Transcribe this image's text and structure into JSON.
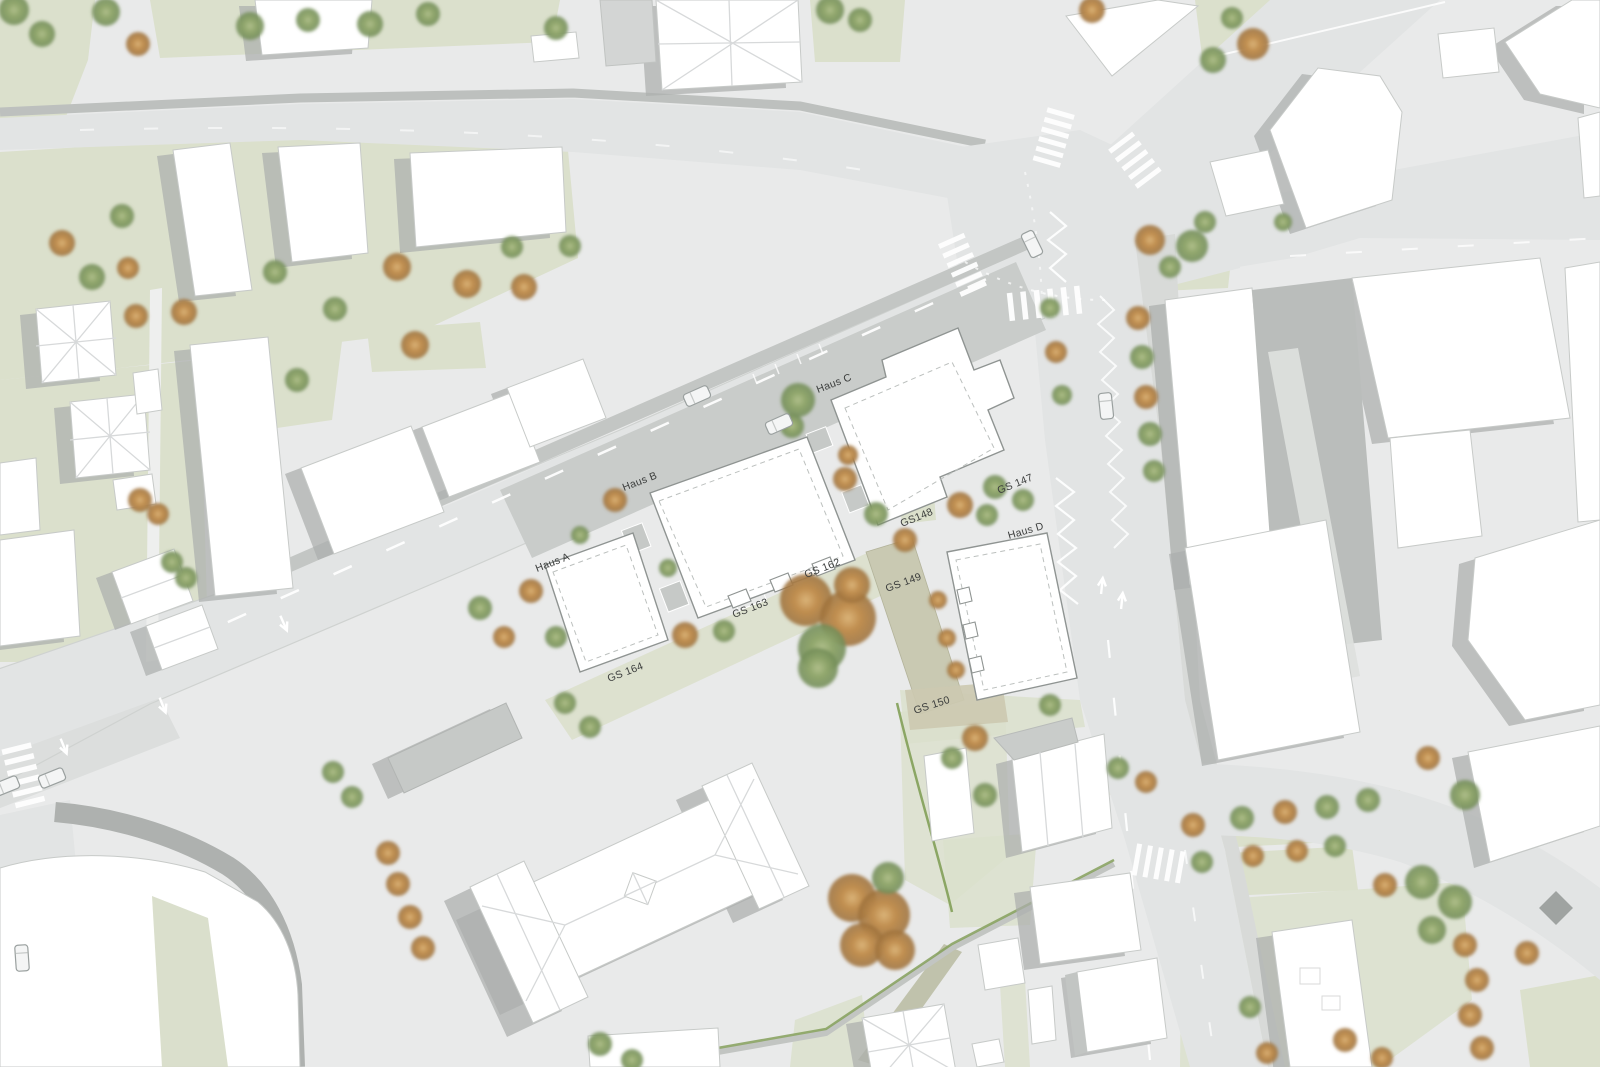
{
  "plan": {
    "title": "Urban site plan with new buildings Haus A-D and parcels",
    "labels": [
      {
        "id": "haus-a",
        "text": "Haus A",
        "x": 537,
        "y": 572,
        "rotate": -21
      },
      {
        "id": "haus-b",
        "text": "Haus B",
        "x": 624,
        "y": 491,
        "rotate": -21
      },
      {
        "id": "haus-c",
        "text": "Haus C",
        "x": 818,
        "y": 393,
        "rotate": -21
      },
      {
        "id": "haus-d",
        "text": "Haus D",
        "x": 1009,
        "y": 539,
        "rotate": -16
      },
      {
        "id": "gs-147",
        "text": "GS 147",
        "x": 999,
        "y": 494,
        "rotate": -22
      },
      {
        "id": "gs-148",
        "text": "GS148",
        "x": 902,
        "y": 527,
        "rotate": -22
      },
      {
        "id": "gs-149",
        "text": "GS 149",
        "x": 887,
        "y": 592,
        "rotate": -20
      },
      {
        "id": "gs-150",
        "text": "GS 150",
        "x": 915,
        "y": 714,
        "rotate": -18
      },
      {
        "id": "gs-162",
        "text": "GS 162",
        "x": 806,
        "y": 578,
        "rotate": -21
      },
      {
        "id": "gs-163",
        "text": "GS 163",
        "x": 734,
        "y": 618,
        "rotate": -21
      },
      {
        "id": "gs-164",
        "text": "GS 164",
        "x": 609,
        "y": 682,
        "rotate": -21
      }
    ],
    "colors": {
      "paving": "#e9eaea",
      "road": "#e2e4e4",
      "sidewalk": "#c9ccca",
      "lawn": "#dbe0cc",
      "building": "#ffffff",
      "shadow": "#acafad",
      "tree_green": "#87a061",
      "tree_autumn": "#c18a4d",
      "parcel_band": "#c9c9b2",
      "marking": "#ffffff"
    },
    "trees": [
      [
        14,
        10,
        15,
        "g"
      ],
      [
        42,
        34,
        13,
        "g"
      ],
      [
        106,
        12,
        14,
        "g"
      ],
      [
        138,
        44,
        12,
        "o"
      ],
      [
        250,
        26,
        14,
        "g"
      ],
      [
        308,
        20,
        12,
        "g"
      ],
      [
        370,
        24,
        13,
        "g"
      ],
      [
        428,
        14,
        12,
        "g"
      ],
      [
        556,
        28,
        12,
        "g"
      ],
      [
        830,
        10,
        14,
        "g"
      ],
      [
        860,
        20,
        12,
        "g"
      ],
      [
        1092,
        10,
        13,
        "o"
      ],
      [
        62,
        243,
        13,
        "o"
      ],
      [
        92,
        277,
        13,
        "g"
      ],
      [
        122,
        216,
        12,
        "g"
      ],
      [
        128,
        268,
        11,
        "o"
      ],
      [
        136,
        316,
        12,
        "o"
      ],
      [
        184,
        312,
        13,
        "o"
      ],
      [
        275,
        272,
        12,
        "g"
      ],
      [
        297,
        380,
        12,
        "g"
      ],
      [
        335,
        309,
        12,
        "g"
      ],
      [
        397,
        267,
        14,
        "o"
      ],
      [
        415,
        345,
        14,
        "o"
      ],
      [
        467,
        284,
        14,
        "o"
      ],
      [
        524,
        287,
        13,
        "o"
      ],
      [
        512,
        247,
        11,
        "g"
      ],
      [
        570,
        246,
        11,
        "g"
      ],
      [
        140,
        500,
        12,
        "o"
      ],
      [
        158,
        514,
        11,
        "o"
      ],
      [
        172,
        562,
        11,
        "g"
      ],
      [
        186,
        578,
        11,
        "g"
      ],
      [
        480,
        608,
        12,
        "g"
      ],
      [
        504,
        637,
        11,
        "o"
      ],
      [
        531,
        591,
        12,
        "o"
      ],
      [
        556,
        637,
        11,
        "g"
      ],
      [
        580,
        535,
        9,
        "g"
      ],
      [
        615,
        500,
        12,
        "o"
      ],
      [
        668,
        568,
        9,
        "g"
      ],
      [
        685,
        635,
        13,
        "o"
      ],
      [
        724,
        631,
        11,
        "g"
      ],
      [
        798,
        400,
        17,
        "g"
      ],
      [
        792,
        426,
        12,
        "g"
      ],
      [
        845,
        479,
        12,
        "o"
      ],
      [
        848,
        455,
        10,
        "o"
      ],
      [
        876,
        514,
        12,
        "g"
      ],
      [
        905,
        540,
        12,
        "o"
      ],
      [
        806,
        600,
        26,
        "o"
      ],
      [
        848,
        618,
        28,
        "o"
      ],
      [
        822,
        648,
        24,
        "g"
      ],
      [
        852,
        585,
        18,
        "o"
      ],
      [
        818,
        668,
        20,
        "g"
      ],
      [
        960,
        505,
        13,
        "o"
      ],
      [
        987,
        515,
        11,
        "g"
      ],
      [
        995,
        487,
        12,
        "g"
      ],
      [
        1023,
        500,
        11,
        "g"
      ],
      [
        938,
        600,
        9,
        "o"
      ],
      [
        947,
        638,
        9,
        "o"
      ],
      [
        956,
        670,
        9,
        "o"
      ],
      [
        1150,
        240,
        15,
        "o"
      ],
      [
        1192,
        246,
        16,
        "g"
      ],
      [
        1170,
        267,
        11,
        "g"
      ],
      [
        1205,
        222,
        11,
        "g"
      ],
      [
        1253,
        44,
        16,
        "o"
      ],
      [
        1213,
        60,
        13,
        "g"
      ],
      [
        1232,
        18,
        11,
        "g"
      ],
      [
        1283,
        222,
        9,
        "g"
      ],
      [
        1050,
        308,
        10,
        "g"
      ],
      [
        1056,
        352,
        11,
        "o"
      ],
      [
        1062,
        395,
        10,
        "g"
      ],
      [
        1138,
        318,
        12,
        "o"
      ],
      [
        1142,
        357,
        12,
        "g"
      ],
      [
        1146,
        397,
        12,
        "o"
      ],
      [
        1150,
        434,
        12,
        "g"
      ],
      [
        1154,
        471,
        11,
        "g"
      ],
      [
        333,
        772,
        11,
        "g"
      ],
      [
        352,
        797,
        11,
        "g"
      ],
      [
        388,
        853,
        12,
        "o"
      ],
      [
        398,
        884,
        12,
        "o"
      ],
      [
        410,
        917,
        12,
        "o"
      ],
      [
        423,
        948,
        12,
        "o"
      ],
      [
        565,
        703,
        11,
        "g"
      ],
      [
        590,
        727,
        11,
        "g"
      ],
      [
        852,
        898,
        24,
        "o"
      ],
      [
        884,
        915,
        26,
        "o"
      ],
      [
        862,
        945,
        22,
        "o"
      ],
      [
        888,
        878,
        16,
        "g"
      ],
      [
        895,
        950,
        20,
        "o"
      ],
      [
        600,
        1044,
        12,
        "g"
      ],
      [
        632,
        1060,
        11,
        "g"
      ],
      [
        952,
        758,
        11,
        "g"
      ],
      [
        985,
        795,
        12,
        "g"
      ],
      [
        1050,
        705,
        11,
        "g"
      ],
      [
        975,
        738,
        13,
        "o"
      ],
      [
        1118,
        768,
        11,
        "g"
      ],
      [
        1146,
        782,
        11,
        "o"
      ],
      [
        1193,
        825,
        12,
        "o"
      ],
      [
        1242,
        818,
        12,
        "g"
      ],
      [
        1285,
        812,
        12,
        "o"
      ],
      [
        1327,
        807,
        12,
        "g"
      ],
      [
        1368,
        800,
        12,
        "g"
      ],
      [
        1428,
        758,
        12,
        "o"
      ],
      [
        1465,
        795,
        15,
        "g"
      ],
      [
        1202,
        862,
        11,
        "g"
      ],
      [
        1253,
        856,
        11,
        "o"
      ],
      [
        1297,
        851,
        11,
        "o"
      ],
      [
        1335,
        846,
        11,
        "g"
      ],
      [
        1385,
        885,
        12,
        "o"
      ],
      [
        1422,
        882,
        17,
        "g"
      ],
      [
        1455,
        902,
        17,
        "g"
      ],
      [
        1432,
        930,
        14,
        "g"
      ],
      [
        1465,
        945,
        12,
        "o"
      ],
      [
        1477,
        980,
        12,
        "o"
      ],
      [
        1470,
        1015,
        12,
        "o"
      ],
      [
        1482,
        1048,
        12,
        "o"
      ],
      [
        1527,
        953,
        12,
        "o"
      ],
      [
        1250,
        1007,
        11,
        "g"
      ],
      [
        1267,
        1053,
        11,
        "o"
      ],
      [
        1345,
        1040,
        12,
        "o"
      ],
      [
        1382,
        1058,
        11,
        "o"
      ]
    ],
    "cars": [
      [
        697,
        396,
        -24
      ],
      [
        779,
        424,
        -24
      ],
      [
        1032,
        244,
        64
      ],
      [
        52,
        778,
        -22
      ],
      [
        6,
        786,
        -22
      ],
      [
        22,
        958,
        86
      ],
      [
        1106,
        406,
        84
      ]
    ]
  }
}
